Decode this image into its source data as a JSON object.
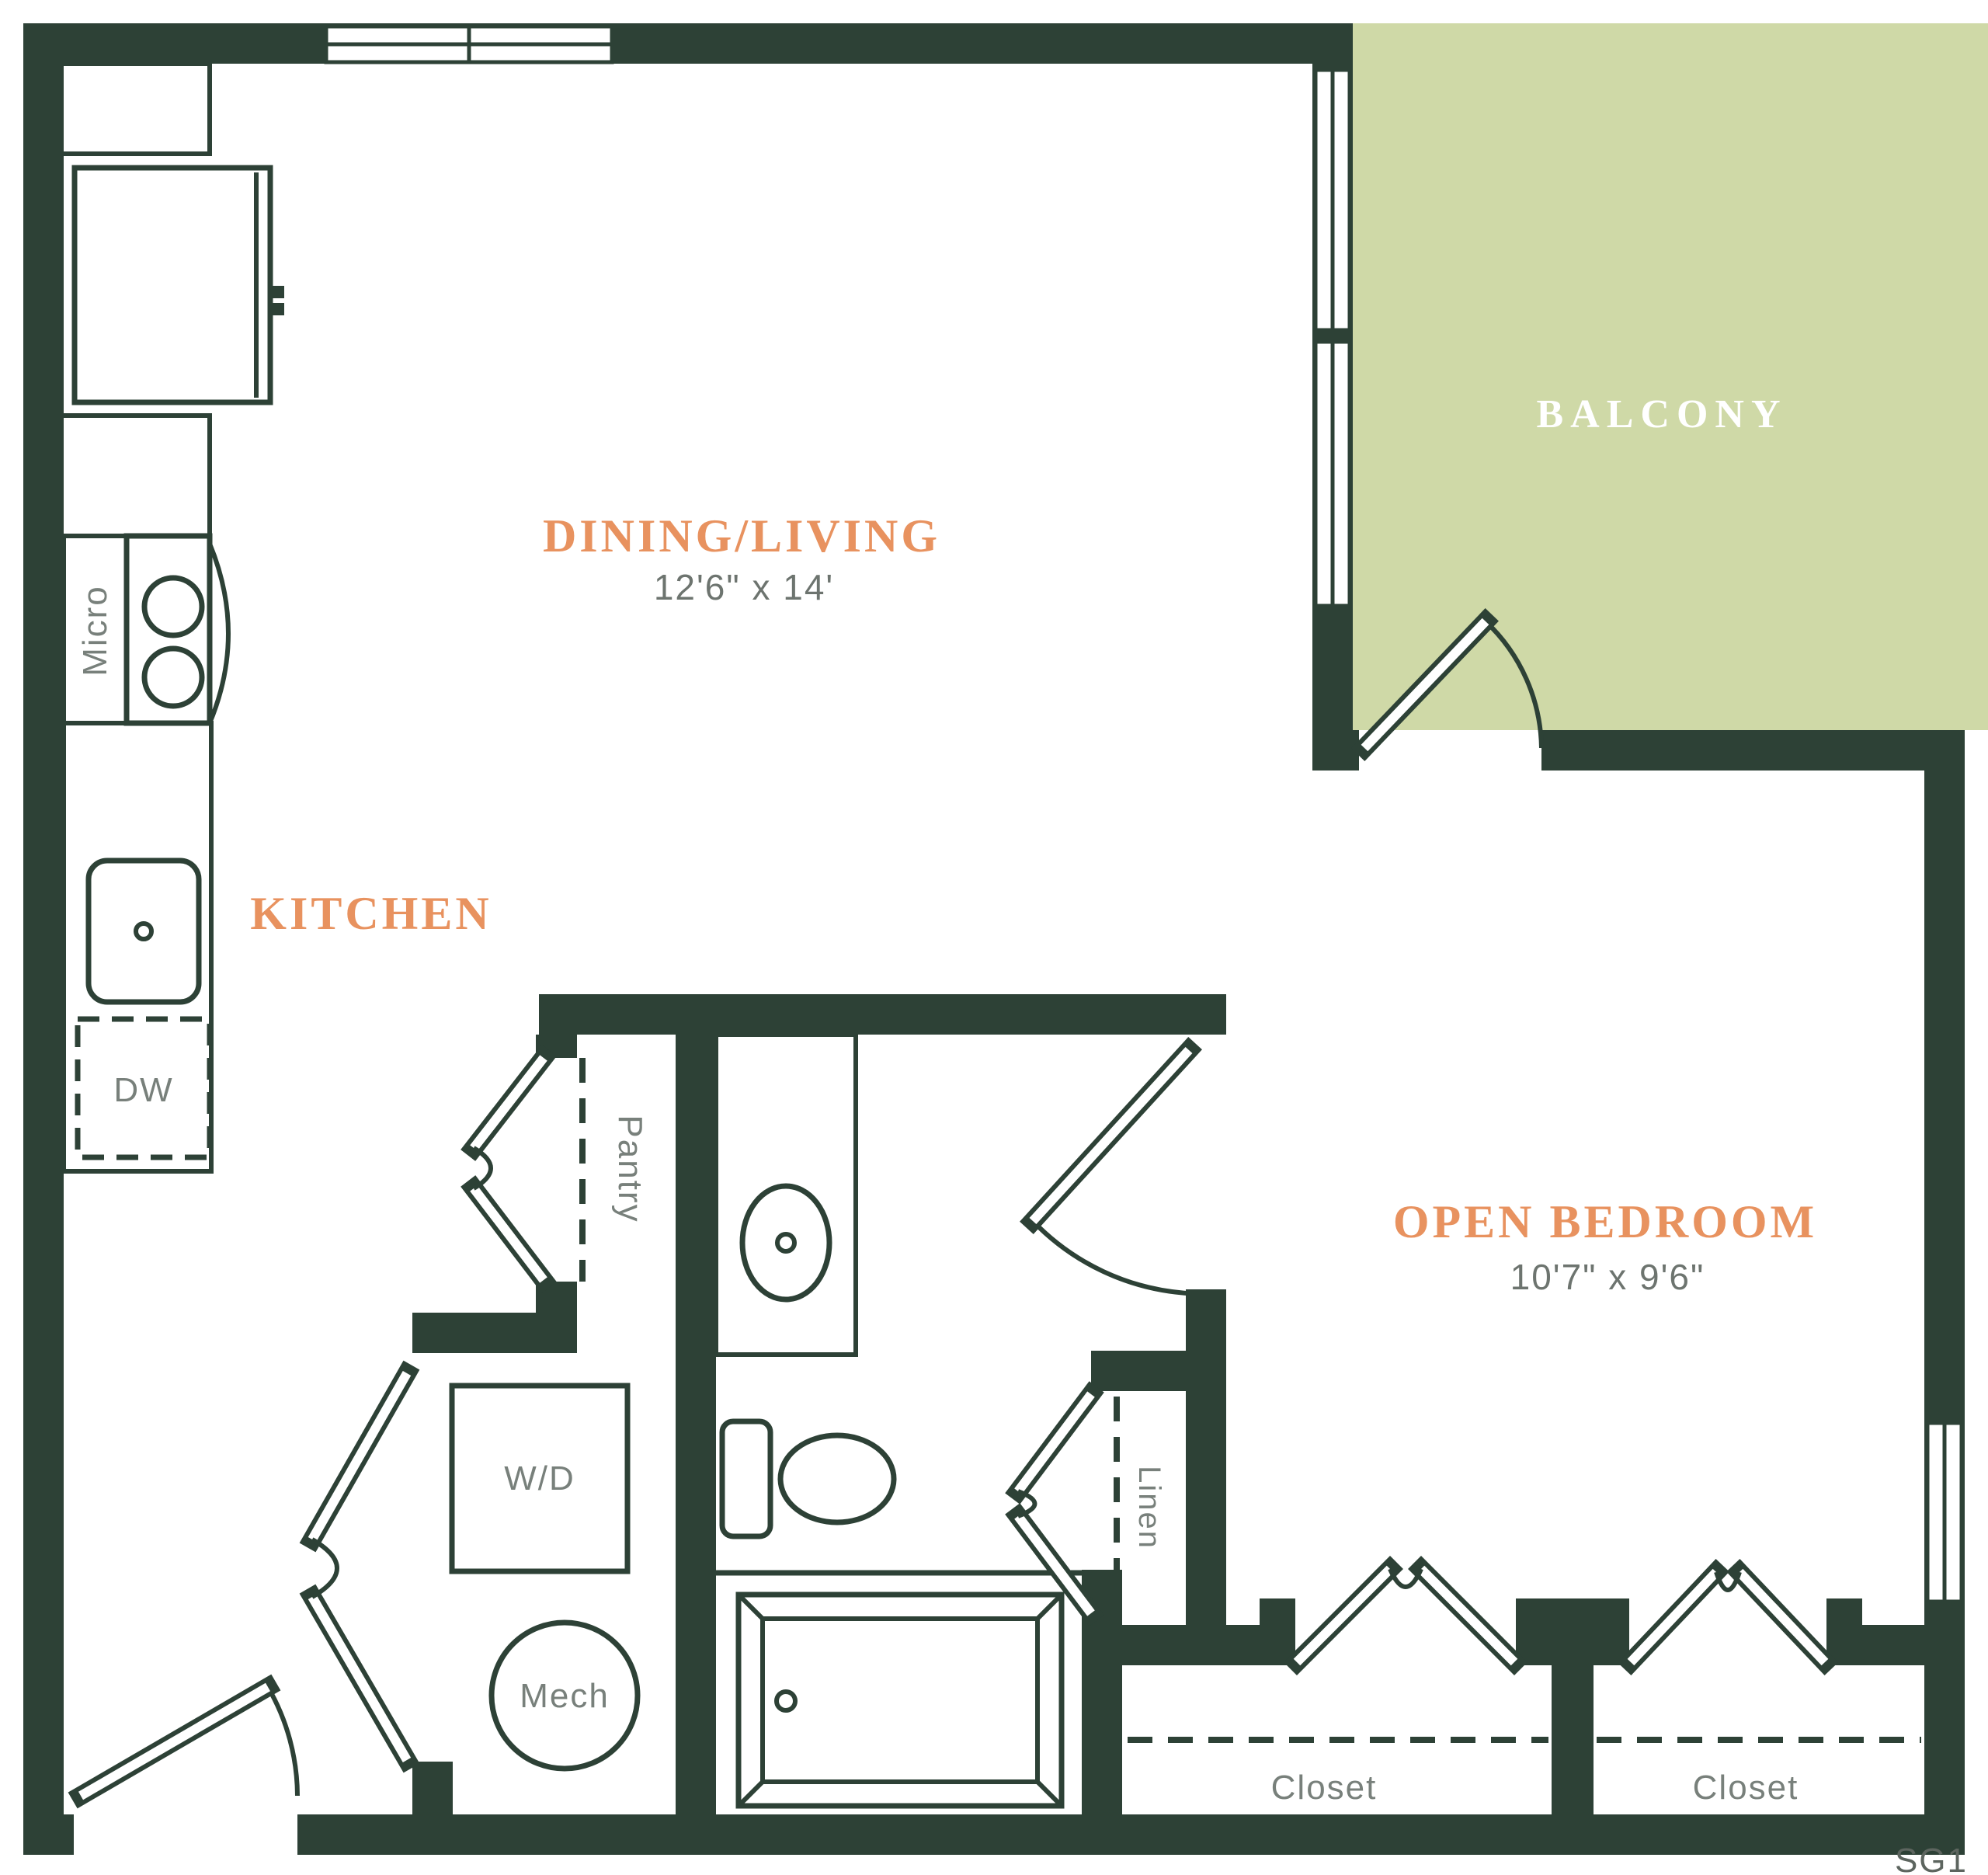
{
  "page": {
    "background": "#ffffff"
  },
  "colors": {
    "wall": "#2d4136",
    "balcony_fill": "#cfd9a7",
    "room_label": "#e8925f",
    "dimension_text": "#6d746f",
    "fixture_text": "#78807b",
    "plan_code_text": "#5d655f"
  },
  "rooms": [
    {
      "name": "DINING/LIVING",
      "dimensions": "12'6\" x 14'"
    },
    {
      "name": "KITCHEN",
      "dimensions": ""
    },
    {
      "name": "OPEN BEDROOM",
      "dimensions": "10'7\" x 9'6\""
    },
    {
      "name": "BALCONY",
      "dimensions": ""
    }
  ],
  "fixtures": {
    "microwave": "Micro",
    "dishwasher": "DW",
    "pantry": "Pantry",
    "washer_dryer": "W/D",
    "mechanical": "Mech",
    "linen": "Linen",
    "closet_left": "Closet",
    "closet_right": "Closet"
  },
  "plan_code": "SG1"
}
